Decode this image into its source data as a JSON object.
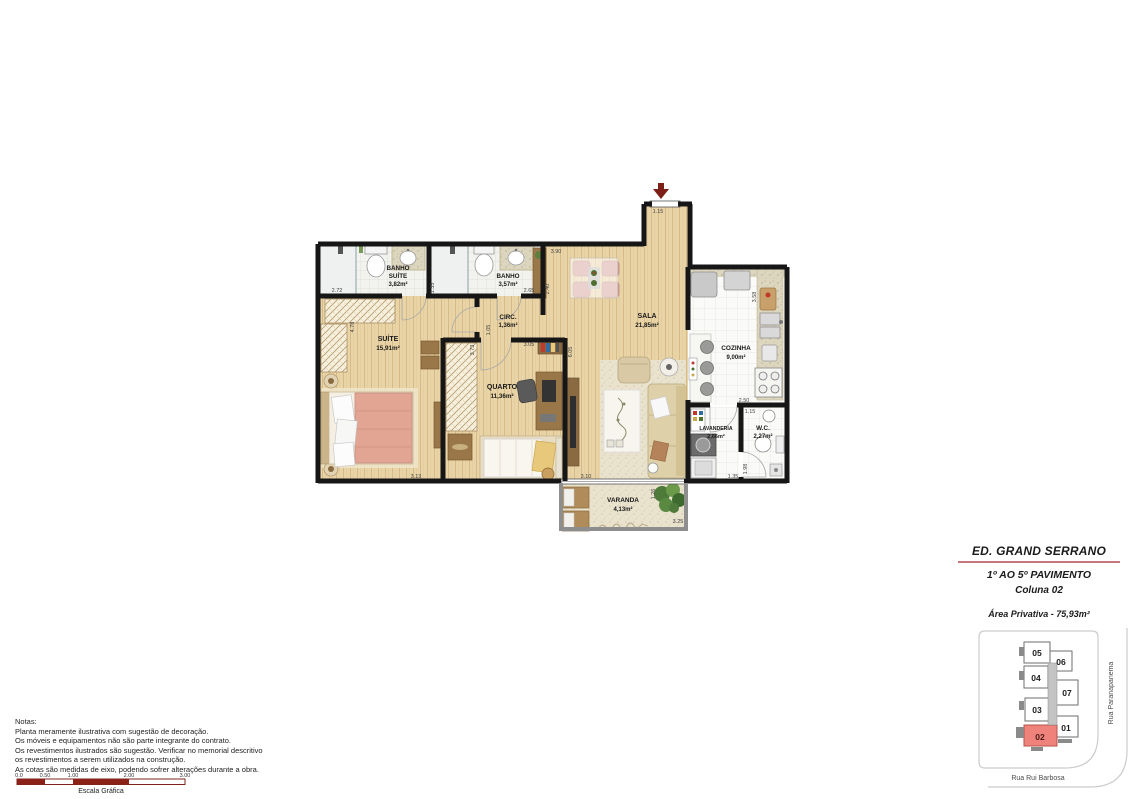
{
  "title_block": {
    "building": "ED. GRAND SERRANO",
    "floors": "1º AO 5º PAVIMENTO",
    "column": "Coluna 02",
    "private_area": "Área Privativa - 75,93m²"
  },
  "plan": {
    "rooms": [
      {
        "name": "BANHO",
        "name2": "SUÍTE",
        "area": "3,82m²"
      },
      {
        "name": "BANHO",
        "area": "3,57m²"
      },
      {
        "name": "CIRC.",
        "area": "1,36m²"
      },
      {
        "name": "SALA",
        "area": "21,85m²"
      },
      {
        "name": "SUÍTE",
        "area": "15,91m²"
      },
      {
        "name": "QUARTO",
        "area": "11,36m²"
      },
      {
        "name": "COZINHA",
        "area": "9,00m²"
      },
      {
        "name": "LAVANDERIA",
        "area": "2,66m²"
      },
      {
        "name": "W.C.",
        "area": "2,27m²"
      },
      {
        "name": "VARANDA",
        "area": "4,13m²"
      }
    ],
    "dims": [
      "1.15",
      "3.90",
      "2.40",
      "2.72",
      "1.35",
      "2.65",
      "4.78",
      "1.05",
      "3.73",
      "3.05",
      "6.05",
      "3.58",
      "2.50",
      "1.15",
      "1.98",
      "1.35",
      "3.13",
      "3.10",
      "1.26",
      "3.25"
    ]
  },
  "key_plan": {
    "units": [
      {
        "label": "05"
      },
      {
        "label": "06"
      },
      {
        "label": "04"
      },
      {
        "label": "07"
      },
      {
        "label": "03"
      },
      {
        "label": "01"
      },
      {
        "label": "02"
      }
    ],
    "highlighted_unit": "02",
    "street_right": "Rua Paranapanema",
    "street_bottom": "Rua Rui Barbosa"
  },
  "notes": {
    "heading": "Notas:",
    "lines": [
      "Planta meramente ilustrativa com sugestão de decoração.",
      "Os móveis e equipamentos não são parte integrante do contrato.",
      "Os revestimentos ilustrados são sugestão. Verificar no memorial descritivo",
      "os revestimentos a serem utilizados na construção.",
      "As cotas são medidas de eixo, podendo sofrer alterações durante a obra."
    ]
  },
  "scale_bar": {
    "ticks": [
      "0.0",
      "0.50",
      "1.00",
      "2.00",
      "3.00"
    ],
    "caption": "Escala Gráfica"
  },
  "colors": {
    "accent_red": "#7d1f17",
    "title_rule": "#c4787a",
    "unit_highlight": "#ef837b",
    "wall": "#161616"
  }
}
